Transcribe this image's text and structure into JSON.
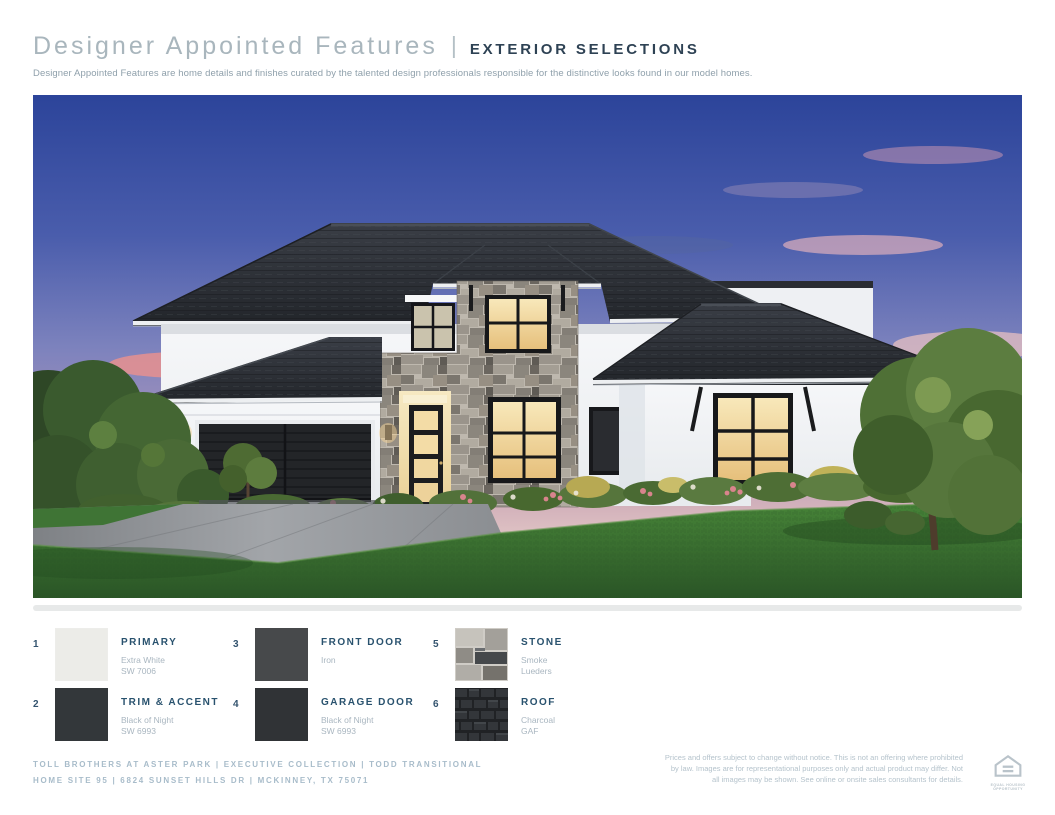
{
  "header": {
    "title": "Designer Appointed Features",
    "divider": "|",
    "section": "EXTERIOR SELECTIONS",
    "description": "Designer Appointed Features are home details and finishes curated by the talented design professionals responsible for the distinctive looks found in our model homes."
  },
  "colors": {
    "title_gray_blue": "#a9b6bd",
    "section_navy": "#2e4254",
    "legend_label_navy": "#29526e",
    "legend_detail_gray": "#a9b6c0",
    "footer_gray_blue": "#a8bcca",
    "divider_gray": "#e7e9e9"
  },
  "photo": {
    "scene": "twilight rendering of two-story white stucco home with stone entry tower, dark hip roofs, black double garage door, lit windows, lawn and landscaping"
  },
  "legend": {
    "items": [
      {
        "num": "1",
        "label": "PRIMARY",
        "detail1": "Extra White",
        "detail2": "SW 7006",
        "swatch_type": "solid",
        "swatch_color": "#ecece8"
      },
      {
        "num": "2",
        "label": "TRIM & ACCENT",
        "detail1": "Black of Night",
        "detail2": "SW 6993",
        "swatch_type": "solid",
        "swatch_color": "#33373a"
      },
      {
        "num": "3",
        "label": "FRONT DOOR",
        "detail1": "Iron",
        "detail2": "",
        "swatch_type": "solid",
        "swatch_color": "#47494b"
      },
      {
        "num": "4",
        "label": "GARAGE DOOR",
        "detail1": "Black of Night",
        "detail2": "SW 6993",
        "swatch_type": "solid",
        "swatch_color": "#303336"
      },
      {
        "num": "5",
        "label": "STONE",
        "detail1": "Smoke",
        "detail2": "Lueders",
        "swatch_type": "texture",
        "swatch_color": "#b0ada7"
      },
      {
        "num": "6",
        "label": "ROOF",
        "detail1": "Charcoal",
        "detail2": "GAF",
        "swatch_type": "texture",
        "swatch_color": "#2a2c30"
      }
    ]
  },
  "footer": {
    "line1": "TOLL BROTHERS AT ASTER PARK  |  EXECUTIVE COLLECTION  |  TODD TRANSITIONAL",
    "line2": "HOME SITE 95  |  6824 SUNSET HILLS DR  |  MCKINNEY, TX 75071",
    "disclaimer": "Prices and offers subject to change without notice. This is not an offering where prohibited by law. Images are for representational purposes only and actual product may differ. Not all images may be shown. See online or onsite sales consultants for details.",
    "equal_housing": "EQUAL HOUSING OPPORTUNITY"
  }
}
